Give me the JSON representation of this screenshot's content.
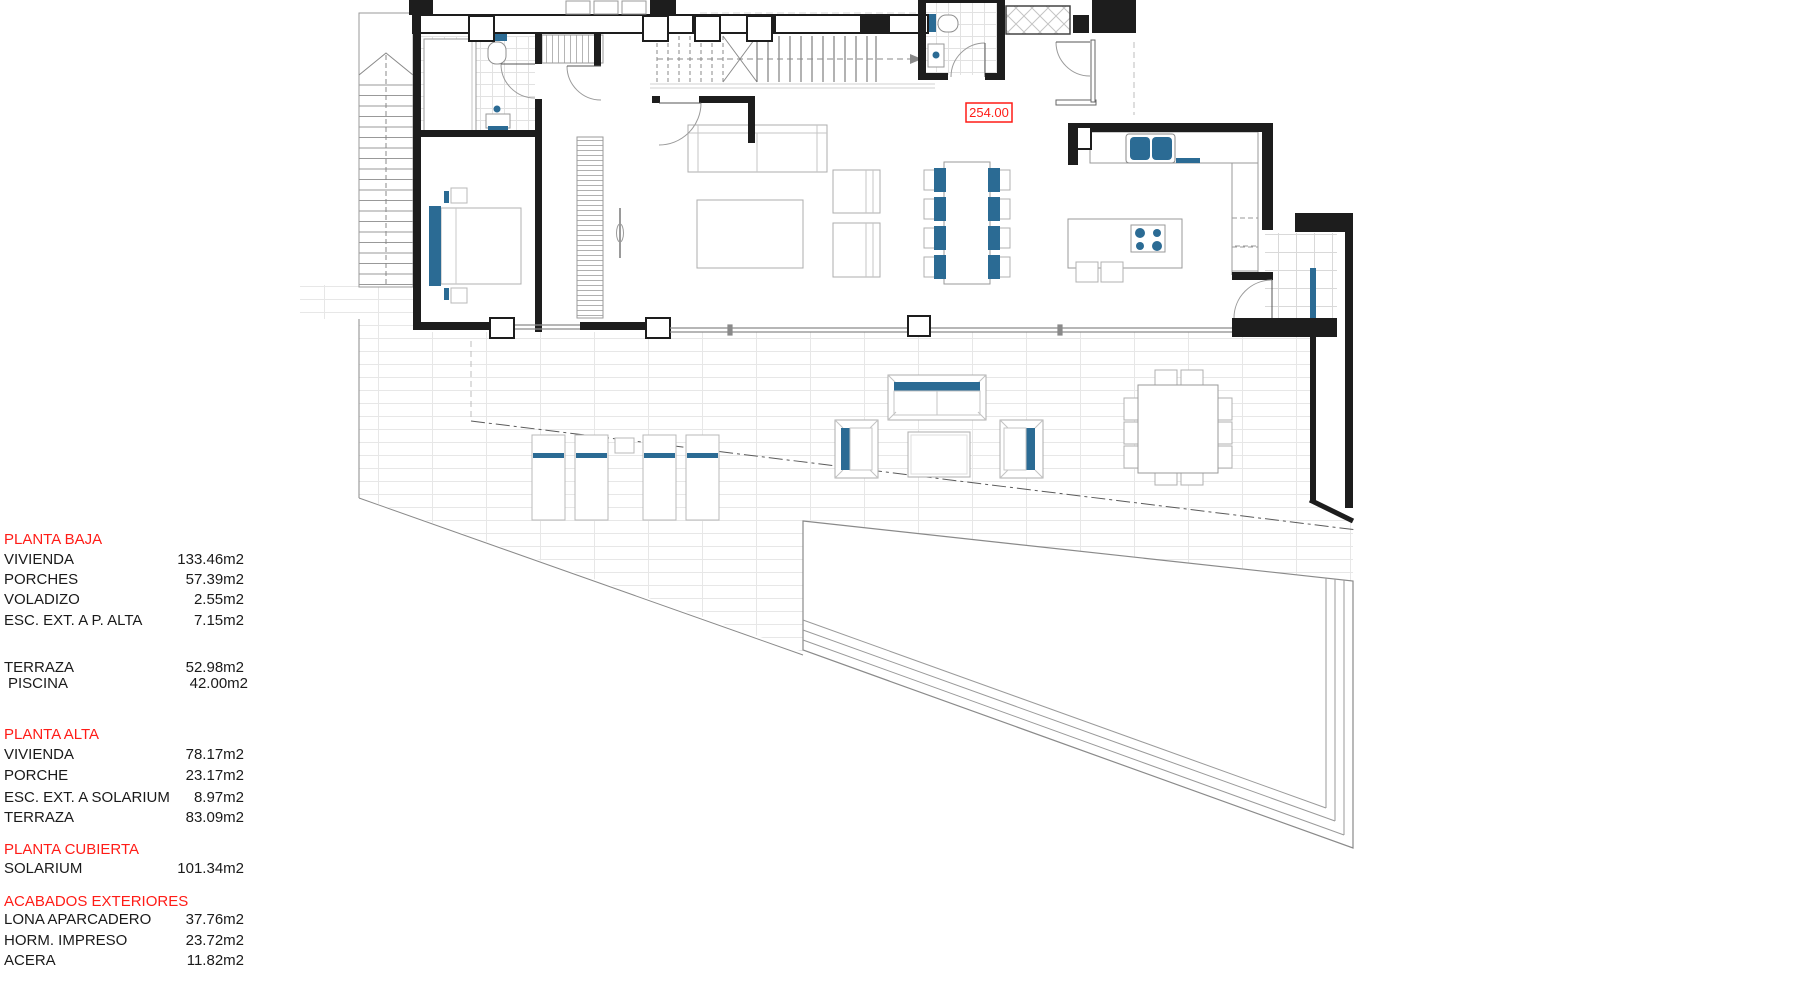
{
  "annotations": {
    "level_mark": "254.00"
  },
  "legend": {
    "rows": [
      {
        "label": "PLANTA BAJA",
        "value": "",
        "type": "header"
      },
      {
        "label": "VIVIENDA",
        "value": "133.46m2"
      },
      {
        "label": "PORCHES",
        "value": "57.39m2"
      },
      {
        "label": "VOLADIZO",
        "value": "2.55m2"
      },
      {
        "label": "ESC. EXT. A P. ALTA",
        "value": "7.15m2"
      },
      {
        "label": "TERRAZA",
        "value": "52.98m2"
      },
      {
        "label": "PISCINA",
        "value": "42.00m2"
      },
      {
        "label": "PLANTA ALTA",
        "value": "",
        "type": "header"
      },
      {
        "label": "VIVIENDA",
        "value": "78.17m2"
      },
      {
        "label": "PORCHE",
        "value": "23.17m2"
      },
      {
        "label": "ESC. EXT. A SOLARIUM",
        "value": "8.97m2"
      },
      {
        "label": "TERRAZA",
        "value": "83.09m2"
      },
      {
        "label": "PLANTA CUBIERTA",
        "value": "",
        "type": "header"
      },
      {
        "label": "SOLARIUM",
        "value": "101.34m2"
      },
      {
        "label": "ACABADOS EXTERIORES",
        "value": "",
        "type": "header"
      },
      {
        "label": "LONA APARCADERO",
        "value": "37.76m2"
      },
      {
        "label": "HORM. IMPRESO",
        "value": "23.72m2"
      },
      {
        "label": "ACERA",
        "value": "11.82m2"
      }
    ]
  },
  "colors": {
    "accent_blue": "#2b6b94",
    "annotation_red": "#ff1c17",
    "wall_dark": "#1d1d1d",
    "tile_line": "#e7e7e7",
    "furniture_line": "#b0b0b0"
  }
}
